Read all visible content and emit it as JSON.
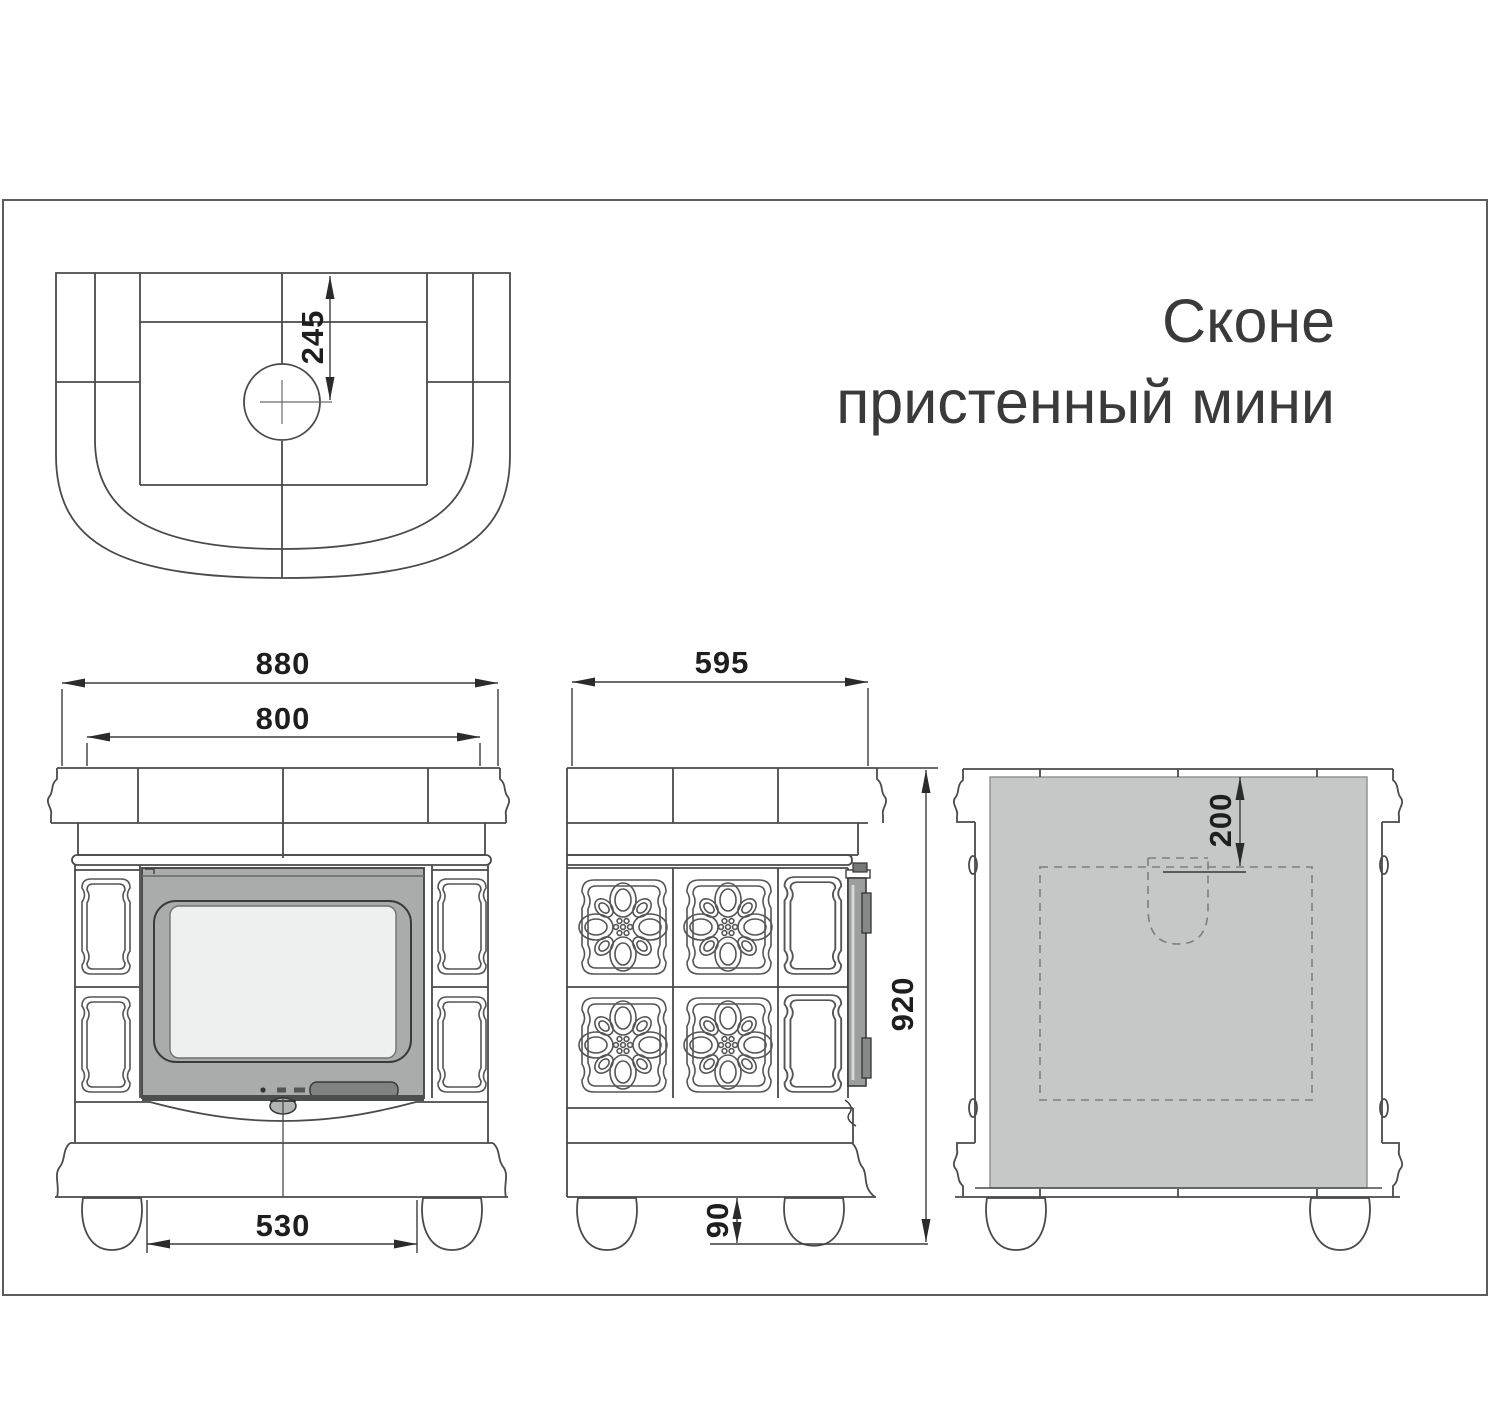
{
  "title": {
    "line1": "Сконе",
    "line2": "пристенный мини"
  },
  "dimensions": {
    "top_flue_offset": "245",
    "front_overall_width": "880",
    "front_body_width": "800",
    "front_feet_span": "530",
    "side_depth": "595",
    "side_height": "920",
    "foot_height": "90",
    "back_flue_top_offset": "200"
  },
  "colors": {
    "line": "#4a4a4a",
    "door_gray": "#a9acab",
    "glass_gray": "#eef0ef",
    "back_panel_gray": "#c5c8c7",
    "handle_gray": "#7f8281",
    "door_bottom_strip": "#4b4e4d"
  }
}
